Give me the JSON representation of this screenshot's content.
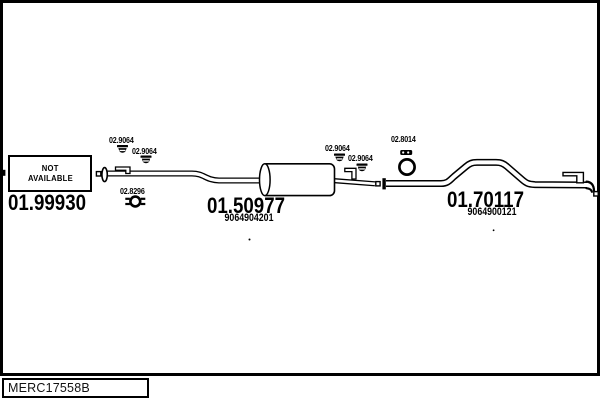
{
  "colors": {
    "line": "#000000",
    "background": "#ffffff",
    "frame": "#000000"
  },
  "diagram": {
    "not_available": {
      "line1": "NOT",
      "line2": "AVAILABLE"
    },
    "parts": [
      {
        "number": "01.99930"
      },
      {
        "number": "01.50977",
        "oem": "9064904201"
      },
      {
        "number": "01.70117",
        "oem": "9064900121"
      }
    ],
    "fittings": [
      {
        "label": "02.9064",
        "type": "clamp"
      },
      {
        "label": "02.9064",
        "type": "clamp"
      },
      {
        "label": "02.8296",
        "type": "pipe-connector-clamp"
      },
      {
        "label": "02.9064",
        "type": "clamp"
      },
      {
        "label": "02.9064",
        "type": "clamp"
      },
      {
        "label": "02.8014",
        "type": "rubber-ring-hanger"
      }
    ]
  },
  "footer": {
    "code": "MERC17558B"
  }
}
